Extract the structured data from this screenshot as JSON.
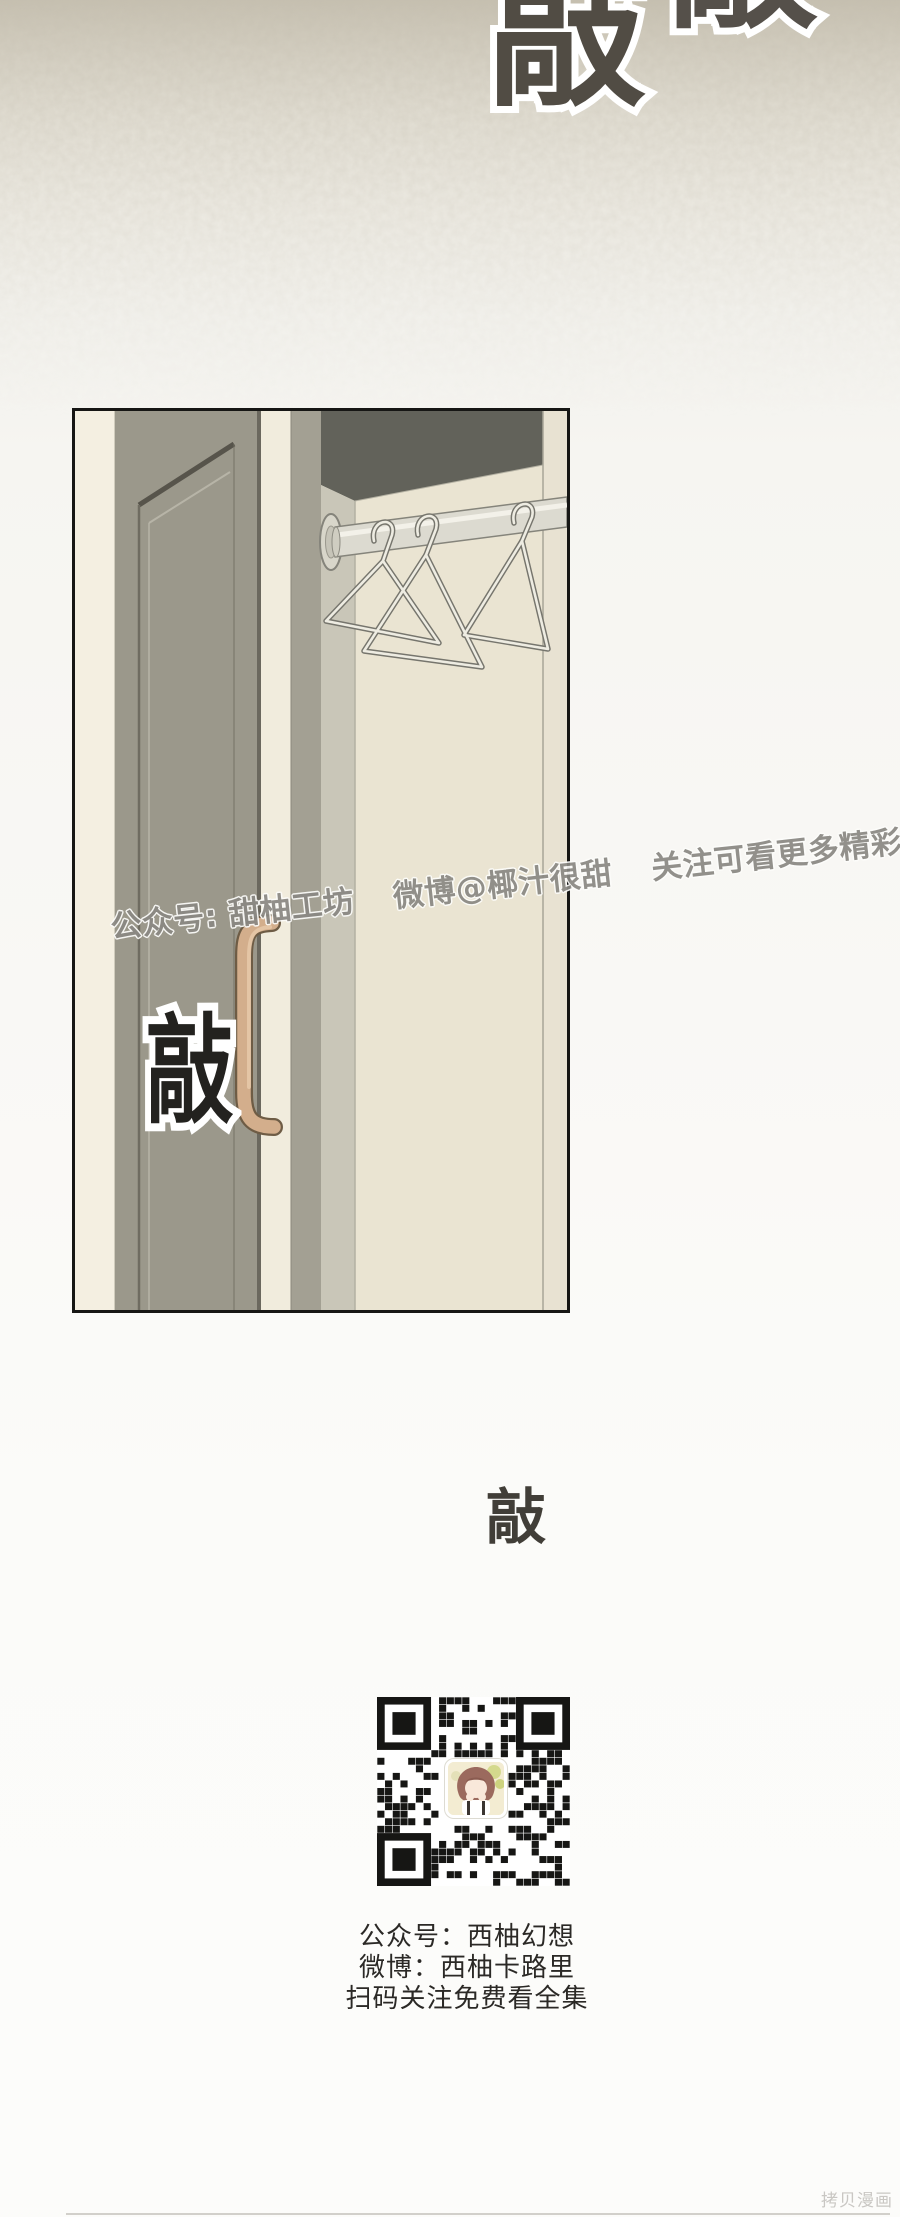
{
  "meta": {
    "width": 900,
    "height": 2217,
    "kind": "webtoon-comic-page"
  },
  "background": {
    "top_color": "#c6c0b0",
    "mid_color": "#eae7de",
    "base_color": "#fbfbf9"
  },
  "sfx": {
    "top_knock": "敲",
    "top_knock_partial": "敲",
    "panel_knock": "敲",
    "below_panel_knock": "敲",
    "top_fill_color": "#514c44",
    "panel_fill_color": "#23221f",
    "mid_fill_color": "#413e38",
    "outline_color": "#ffffff"
  },
  "watermark": {
    "segments": [
      "公众号: 甜柚工坊",
      "微博@椰汁很甜",
      "关注可看更多精彩全集"
    ],
    "color": "#8a8883"
  },
  "panel": {
    "border_color": "#161614",
    "door_color": "#9b988b",
    "frame_cream_color": "#f0ebdb",
    "interior_top_color": "#62625a",
    "back_wall_color": "#eae4d2",
    "side_wall_color": "#c9c6b8",
    "rail_color": "#dcdad0",
    "handle_color": "#d3ae8c",
    "hanger_count": 3
  },
  "qr": {
    "module_color": "#161614",
    "background_color": "#ffffff",
    "caption_lines": [
      "公众号：西柚幻想",
      "微博：西柚卡路里",
      "扫码关注免费看全集"
    ],
    "caption_color": "#2b2926"
  },
  "footer": {
    "site_mark": "拷贝漫画",
    "color": "#c9c7c3"
  }
}
